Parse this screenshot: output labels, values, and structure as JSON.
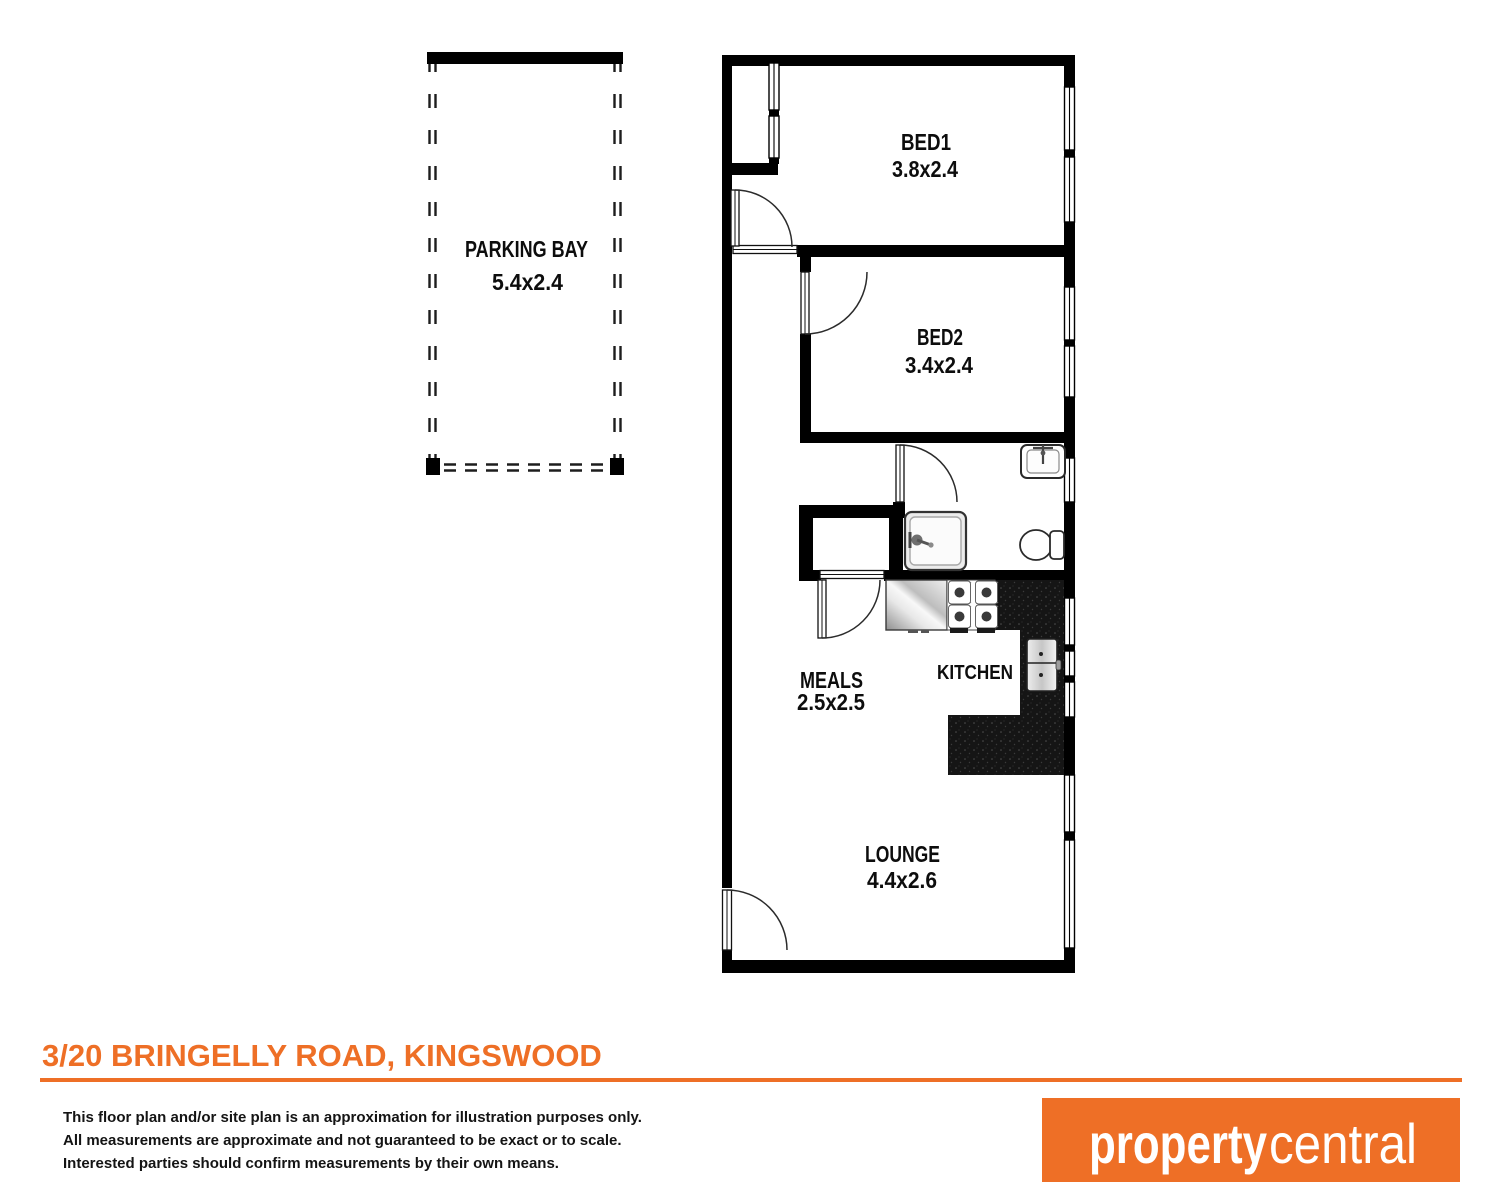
{
  "plan": {
    "parking": {
      "label": "PARKING BAY",
      "dims": "5.4x2.4"
    },
    "bed1": {
      "label": "BED1",
      "dims": "3.8x2.4"
    },
    "bed2": {
      "label": "BED2",
      "dims": "3.4x2.4"
    },
    "meals": {
      "label": "MEALS",
      "dims": "2.5x2.5"
    },
    "kitchen": {
      "label": "KITCHEN"
    },
    "lounge": {
      "label": "LOUNGE",
      "dims": "4.4x2.6"
    }
  },
  "footer": {
    "address": "3/20 BRINGELLY ROAD, KINGSWOOD",
    "disclaimer": [
      "This floor plan and/or site plan is an approximation for illustration purposes only.",
      "All measurements are approximate and not guaranteed to be exact or to scale.",
      "Interested parties should confirm measurements by their own means."
    ]
  },
  "logo": {
    "bold": "property",
    "light": "central"
  },
  "colors": {
    "accent": "#EE6F26",
    "wall": "#000000",
    "counter": "#161616"
  }
}
